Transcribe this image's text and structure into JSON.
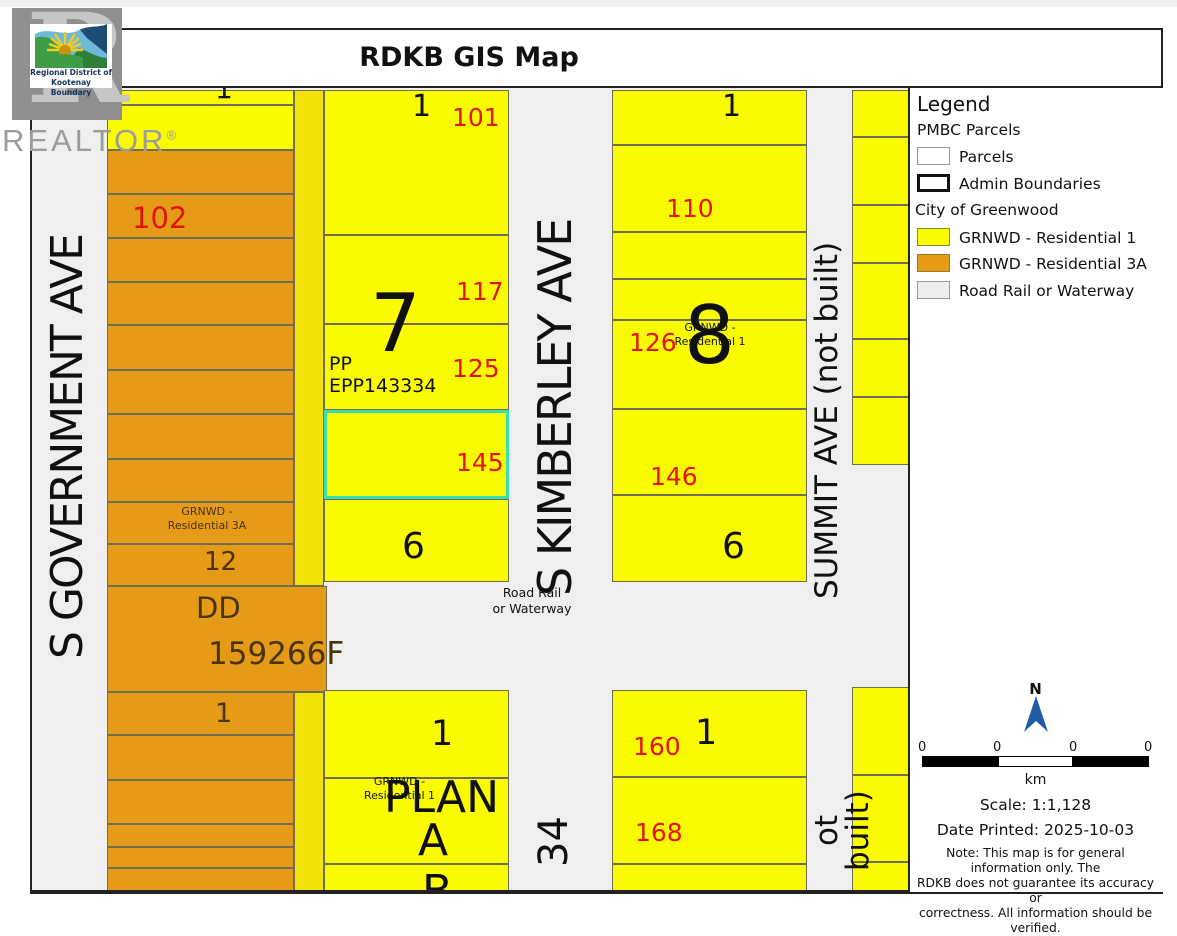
{
  "title": "RDKB GIS Map",
  "logo": {
    "name_line1": "Regional District of",
    "name_line2": "Kootenay Boundary"
  },
  "watermark": {
    "letter": "R",
    "word": "REALTOR",
    "reg": "®"
  },
  "map": {
    "streets": {
      "government": "S GOVERNMENT AVE",
      "kimberley": "S KIMBERLEY AVE",
      "summit": "SUMMIT AVE (not built)",
      "summit_lower_visible": "ot built)"
    },
    "road_area_label": {
      "line1": "Road Rail",
      "line2": "or Waterway"
    },
    "zoning_labels": {
      "res3a_line1": "GRNWD -",
      "res3a_line2": "Residential 3A",
      "res1_line1": "GRNWD -",
      "res1_line2": "Residential 1"
    },
    "parcel_numbers": {
      "p101": "101",
      "p102": "102",
      "p110": "110",
      "p117": "117",
      "p125": "125",
      "p126": "126",
      "p145": "145",
      "p146": "146",
      "p160": "160",
      "p168": "168"
    },
    "block_labels": {
      "block7": "7",
      "block8": "8",
      "block6_west": "6",
      "block6_east": "6",
      "block12": "12",
      "block34": "34",
      "block1_nw": "1",
      "block1_b7": "1",
      "block1_b8": "1",
      "block1_orange": "1",
      "block1_sw": "1",
      "block1_se": "1",
      "plan_word": "PLAN",
      "plan_a": "A",
      "plan_b_partial": "B",
      "dd": "DD",
      "plan_number": "159266F",
      "pp": "PP",
      "epp": "EPP143334"
    }
  },
  "legend": {
    "heading": "Legend",
    "group_pmbc": "PMBC Parcels",
    "items": [
      {
        "swatch": "parcels",
        "label": "Parcels"
      },
      {
        "swatch": "admin-boundaries",
        "label": "Admin Boundaries"
      }
    ],
    "group_city": "City of Greenwood",
    "city_items": [
      {
        "swatch": "grnwd-residential-1",
        "label": "GRNWD - Residential 1"
      },
      {
        "swatch": "grnwd-residential-3a",
        "label": "GRNWD - Residential 3A"
      },
      {
        "swatch": "road-rail-waterway",
        "label": "Road Rail or Waterway"
      }
    ]
  },
  "scale_panel": {
    "north": "N",
    "ticks": [
      "0",
      "0",
      "0",
      "0"
    ],
    "unit": "km",
    "scale_text": "Scale: 1:1,128",
    "date_text": "Date Printed: 2025-10-03",
    "note_lines": [
      "Note: This map is for general information only. The",
      "RDKB does not guarantee its accuracy or",
      "correctness. All information should be verified."
    ]
  },
  "colors": {
    "residential1_fill": "#FBFB00",
    "residential3a_fill": "#E59A18",
    "road_fill": "#EFEFEF",
    "parcel_outline": "#6F6D52",
    "selected_parcel_outline": "#38DFB2",
    "parcel_number_red": "#E01505",
    "north_arrow_blue": "#1E5CA8"
  }
}
